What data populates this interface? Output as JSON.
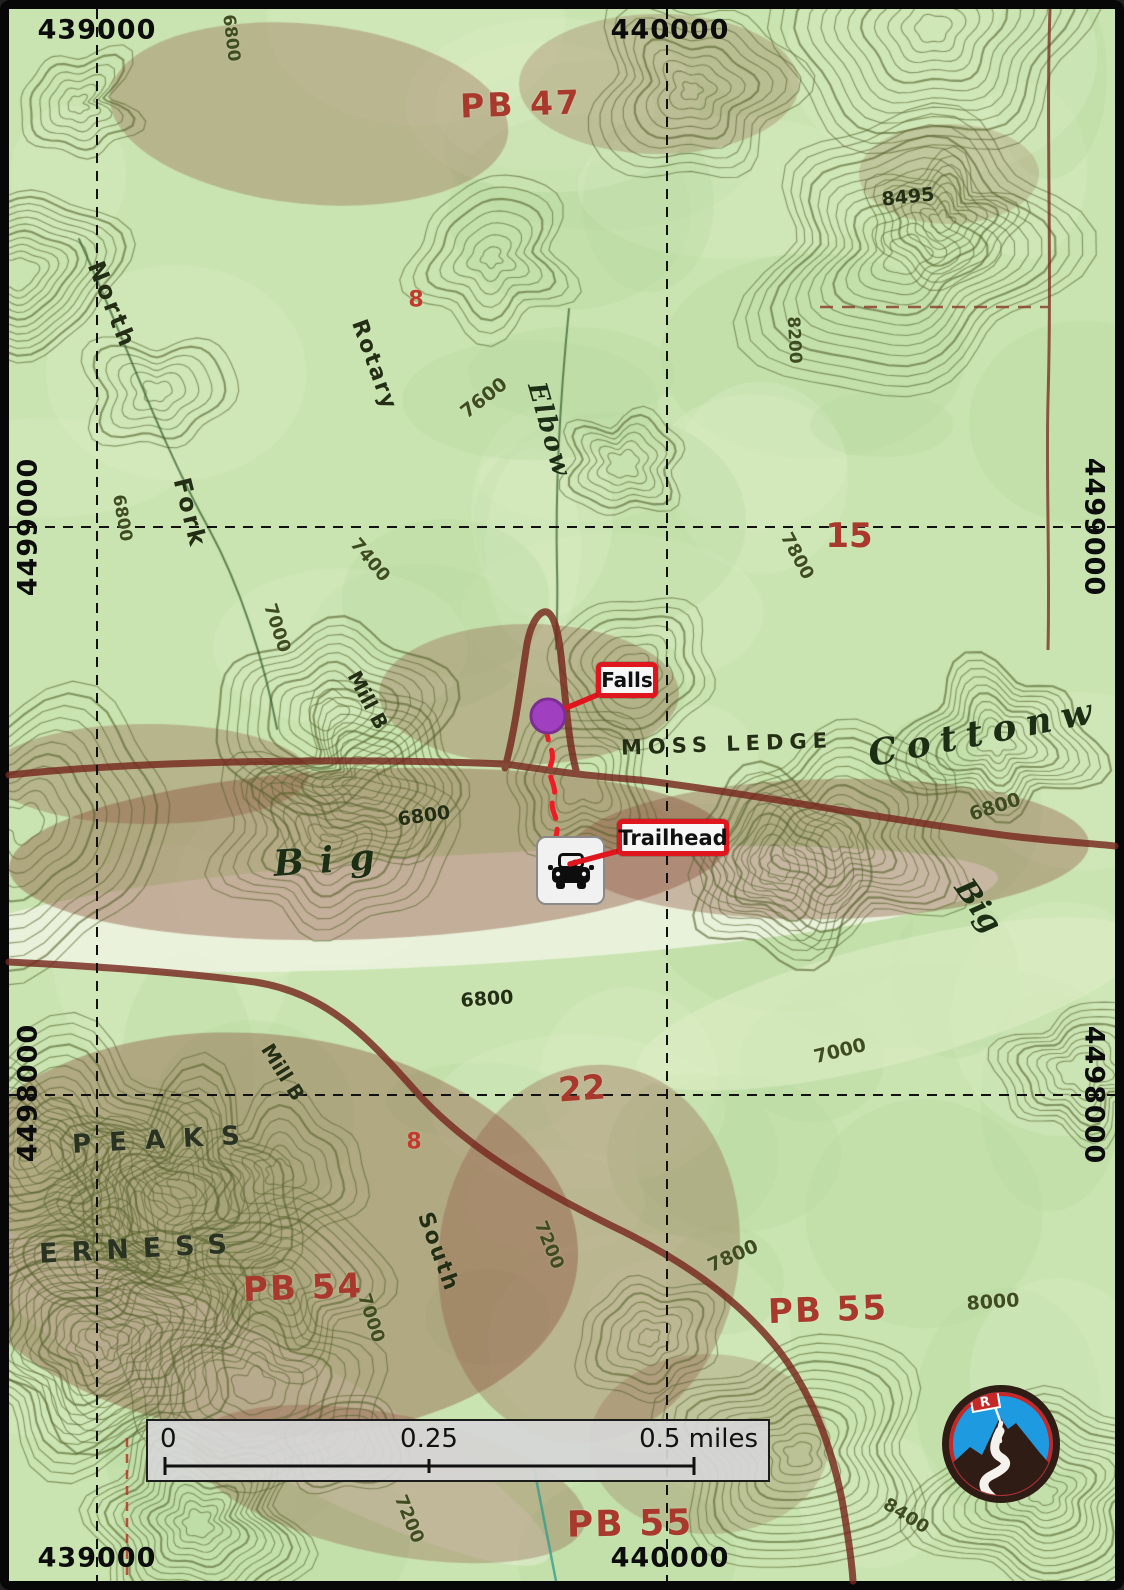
{
  "map": {
    "grid_labels": [
      {
        "t": "439000",
        "x": 97,
        "y": 30,
        "r": 0
      },
      {
        "t": "440000",
        "x": 670,
        "y": 30,
        "r": 0
      },
      {
        "t": "439000",
        "x": 97,
        "y": 1558,
        "r": 0
      },
      {
        "t": "440000",
        "x": 670,
        "y": 1558,
        "r": 0
      },
      {
        "t": "4499000",
        "x": 28,
        "y": 527,
        "r": -90
      },
      {
        "t": "4498000",
        "x": 28,
        "y": 1093,
        "r": -90
      },
      {
        "t": "4499000",
        "x": 1094,
        "y": 527,
        "r": 90
      },
      {
        "t": "4498000",
        "x": 1094,
        "y": 1095,
        "r": 90
      }
    ],
    "topo_labels": [
      {
        "t": "6800",
        "x": 231,
        "y": 38,
        "r": 83,
        "fs": 17,
        "c": "contour"
      },
      {
        "t": "PB 47",
        "x": 521,
        "y": 104,
        "r": -2,
        "fs": 33,
        "c": "red",
        "w": 700,
        "ls": 3
      },
      {
        "t": "8495",
        "x": 908,
        "y": 197,
        "r": -6,
        "fs": 19,
        "c": "dark"
      },
      {
        "t": "North",
        "x": 112,
        "y": 305,
        "r": 68,
        "fs": 24,
        "c": "dark",
        "ls": 3
      },
      {
        "t": "8200",
        "x": 794,
        "y": 340,
        "r": 87,
        "fs": 17,
        "c": "contour"
      },
      {
        "t": "Rotary",
        "x": 374,
        "y": 365,
        "r": 70,
        "fs": 22,
        "c": "dark",
        "ls": 2
      },
      {
        "t": "7600",
        "x": 484,
        "y": 398,
        "r": -38,
        "fs": 19,
        "c": "contour"
      },
      {
        "t": "Elbow",
        "x": 549,
        "y": 430,
        "r": 74,
        "fs": 26,
        "c": "stream",
        "ls": 2,
        "i": 1
      },
      {
        "t": "Fork",
        "x": 190,
        "y": 513,
        "r": 76,
        "fs": 24,
        "c": "dark",
        "ls": 3
      },
      {
        "t": "6800",
        "x": 122,
        "y": 518,
        "r": 80,
        "fs": 17,
        "c": "contour"
      },
      {
        "t": "7400",
        "x": 370,
        "y": 560,
        "r": 50,
        "fs": 18,
        "c": "contour"
      },
      {
        "t": "15",
        "x": 849,
        "y": 536,
        "r": 0,
        "fs": 34,
        "c": "red",
        "w": 700
      },
      {
        "t": "7800",
        "x": 797,
        "y": 556,
        "r": 62,
        "fs": 18,
        "c": "contour"
      },
      {
        "t": "7000",
        "x": 277,
        "y": 628,
        "r": 72,
        "fs": 18,
        "c": "contour"
      },
      {
        "t": "Mill B",
        "x": 368,
        "y": 700,
        "r": 62,
        "fs": 20,
        "c": "dark"
      },
      {
        "t": "MOSS LEDGE",
        "x": 727,
        "y": 744,
        "r": -2,
        "fs": 21,
        "c": "dark",
        "ls": 6
      },
      {
        "t": "Cottonw",
        "x": 985,
        "y": 732,
        "r": -11,
        "fs": 36,
        "c": "stream",
        "ls": 10,
        "i": 1
      },
      {
        "t": "6800",
        "x": 424,
        "y": 816,
        "r": -8,
        "fs": 19,
        "c": "dark"
      },
      {
        "t": "Big",
        "x": 332,
        "y": 860,
        "r": -4,
        "fs": 36,
        "c": "stream",
        "ls": 16,
        "i": 1
      },
      {
        "t": "6800",
        "x": 995,
        "y": 807,
        "r": -18,
        "fs": 19,
        "c": "contour"
      },
      {
        "t": "Big",
        "x": 978,
        "y": 906,
        "r": 55,
        "fs": 30,
        "c": "stream",
        "i": 1
      },
      {
        "t": "6800",
        "x": 487,
        "y": 999,
        "r": -4,
        "fs": 19,
        "c": "dark"
      },
      {
        "t": "7000",
        "x": 840,
        "y": 1051,
        "r": -14,
        "fs": 19,
        "c": "contour"
      },
      {
        "t": "22",
        "x": 582,
        "y": 1089,
        "r": -4,
        "fs": 34,
        "c": "red",
        "w": 700
      },
      {
        "t": "Mill B",
        "x": 283,
        "y": 1072,
        "r": 58,
        "fs": 20,
        "c": "dark"
      },
      {
        "t": "8",
        "x": 416,
        "y": 300,
        "r": 0,
        "fs": 22,
        "c": "red2",
        "w": 700
      },
      {
        "t": "8",
        "x": 414,
        "y": 1142,
        "r": 0,
        "fs": 22,
        "c": "red2",
        "w": 700
      },
      {
        "t": "PEAKS",
        "x": 165,
        "y": 1140,
        "r": -3,
        "fs": 26,
        "c": "dark2",
        "ls": 18
      },
      {
        "t": "South",
        "x": 438,
        "y": 1252,
        "r": 70,
        "fs": 22,
        "c": "dark",
        "ls": 2
      },
      {
        "t": "ERNESS",
        "x": 140,
        "y": 1249,
        "r": -3,
        "fs": 27,
        "c": "dark2",
        "ls": 14
      },
      {
        "t": "7200",
        "x": 549,
        "y": 1245,
        "r": 68,
        "fs": 18,
        "c": "contour"
      },
      {
        "t": "PB 54",
        "x": 303,
        "y": 1288,
        "r": -2,
        "fs": 34,
        "c": "red",
        "w": 700,
        "ls": 2
      },
      {
        "t": "7800",
        "x": 733,
        "y": 1256,
        "r": -24,
        "fs": 19,
        "c": "contour"
      },
      {
        "t": "PB 55",
        "x": 828,
        "y": 1310,
        "r": -2,
        "fs": 34,
        "c": "red",
        "w": 700,
        "ls": 2
      },
      {
        "t": "8000",
        "x": 993,
        "y": 1302,
        "r": -4,
        "fs": 19,
        "c": "contour"
      },
      {
        "t": "7000",
        "x": 371,
        "y": 1318,
        "r": 72,
        "fs": 18,
        "c": "contour"
      },
      {
        "t": "7200",
        "x": 409,
        "y": 1519,
        "r": 68,
        "fs": 18,
        "c": "contour"
      },
      {
        "t": "PB 55",
        "x": 630,
        "y": 1524,
        "r": -1,
        "fs": 36,
        "c": "red",
        "w": 700,
        "ls": 2
      },
      {
        "t": "8400",
        "x": 906,
        "y": 1516,
        "r": 32,
        "fs": 18,
        "c": "contour"
      }
    ],
    "label_colors": {
      "dark": "#232e15",
      "dark2": "#2a3322",
      "contour": "#3f4c20",
      "stream": "#1c2e14",
      "red": "#a8392c",
      "red2": "#c23a2e"
    },
    "markers": {
      "falls": {
        "label": "Falls"
      },
      "trailhead": {
        "label": "Trailhead"
      }
    },
    "scale_bar": {
      "start": "0",
      "middle": "0.25",
      "end": "0.5 miles"
    },
    "logo": {
      "flag_letter": "R"
    }
  },
  "colors": {
    "accent_red": "#E0161F",
    "route_red": "#EE1C25",
    "marker_purple": "#A040C0",
    "topo_trail_maroon": "#76281E",
    "scalebar_bg": "#D6D6D6",
    "logo_blue": "#1E9BE0",
    "logo_brown": "#2E1C15",
    "logo_red": "#C62828"
  }
}
